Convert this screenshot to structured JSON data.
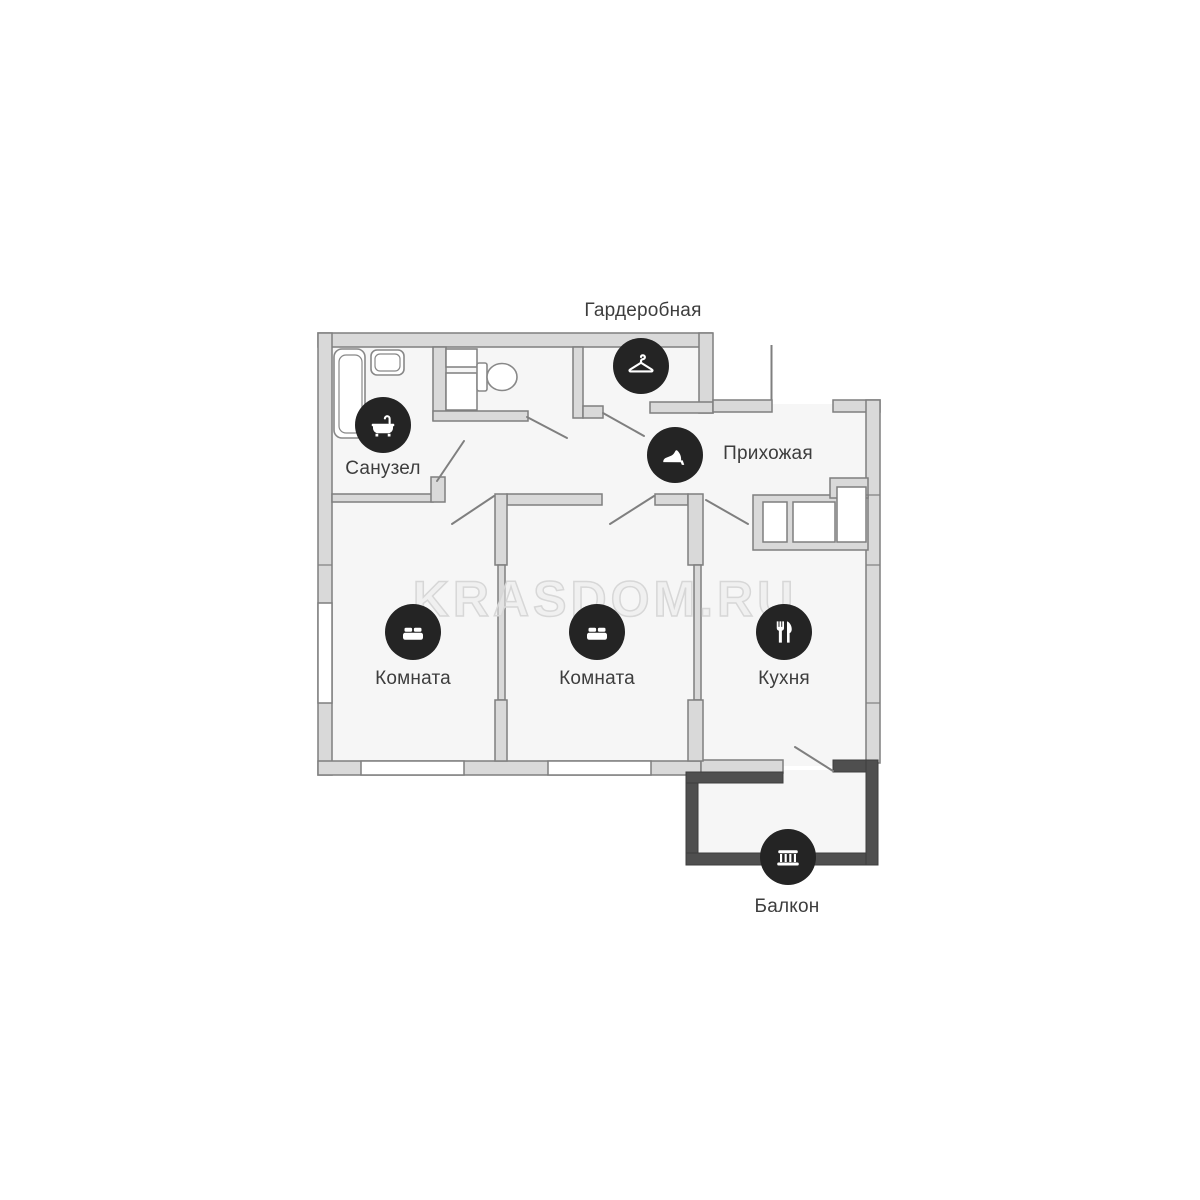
{
  "watermark": "KRASDOM.RU",
  "rooms": {
    "wardrobe": {
      "label": "Гардеробная",
      "icon": "hanger-icon"
    },
    "bathroom": {
      "label": "Санузел",
      "icon": "bathtub-icon"
    },
    "hallway": {
      "label": "Прихожая",
      "icon": "shoe-icon"
    },
    "room1": {
      "label": "Комната",
      "icon": "bed-icon"
    },
    "room2": {
      "label": "Комната",
      "icon": "bed-icon"
    },
    "kitchen": {
      "label": "Кухня",
      "icon": "utensils-icon"
    },
    "balcony": {
      "label": "Балкон",
      "icon": "railing-icon"
    }
  },
  "colors": {
    "badge": "#242424",
    "label": "#3d3d3d",
    "wall_fill": "#d9d9d9",
    "wall_stroke": "#7f7f7f",
    "balcony_wall": "#4f4f4f",
    "floor_fill": "#f6f6f6",
    "watermark_stroke": "#d7d7d7"
  }
}
